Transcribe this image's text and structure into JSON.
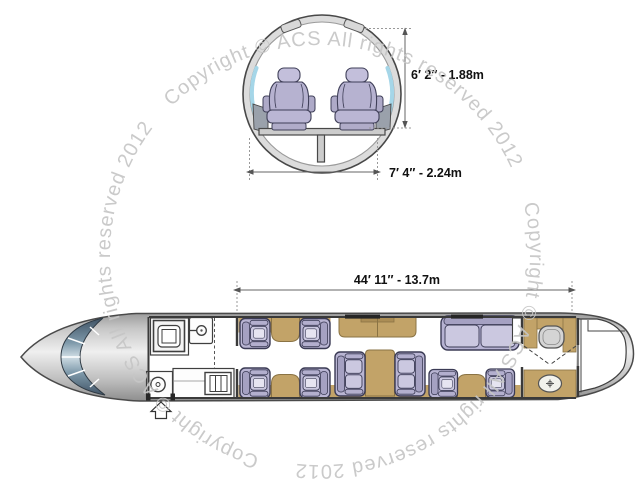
{
  "title": "Aircraft cabin cross-section and floor plan diagram",
  "watermark": {
    "text": "Copyright © ACS All rights reserved 2012",
    "color": "#c6c6c6",
    "repetitions": 3,
    "layout": "circular"
  },
  "cross_section": {
    "height_label": "6′ 2″ - 1.88m",
    "width_label": "7′ 4″ - 2.24m",
    "seat_count": 2
  },
  "floor_plan": {
    "length_label": "44′ 11″ - 13.7m",
    "single_seat_count": 8,
    "divan_seat_count": 3,
    "zones": [
      "cockpit",
      "entry-door",
      "galley",
      "forward-club-seating",
      "credenza",
      "conference-group",
      "three-seat-divan",
      "aft-club-seating",
      "lavatory",
      "baggage-compartment"
    ]
  },
  "colors": {
    "seat_upholstery": "#b9b5d3",
    "seat_cushion": "#cbc8e0",
    "cabinetry_tan": "#c2a368",
    "hull_gray": "#c9c9c9",
    "windshield_blue": "#46586a",
    "cabin_window_blue": "#a5d6e8",
    "dimension_text": "#111111",
    "watermark_gray": "#c6c6c6"
  }
}
